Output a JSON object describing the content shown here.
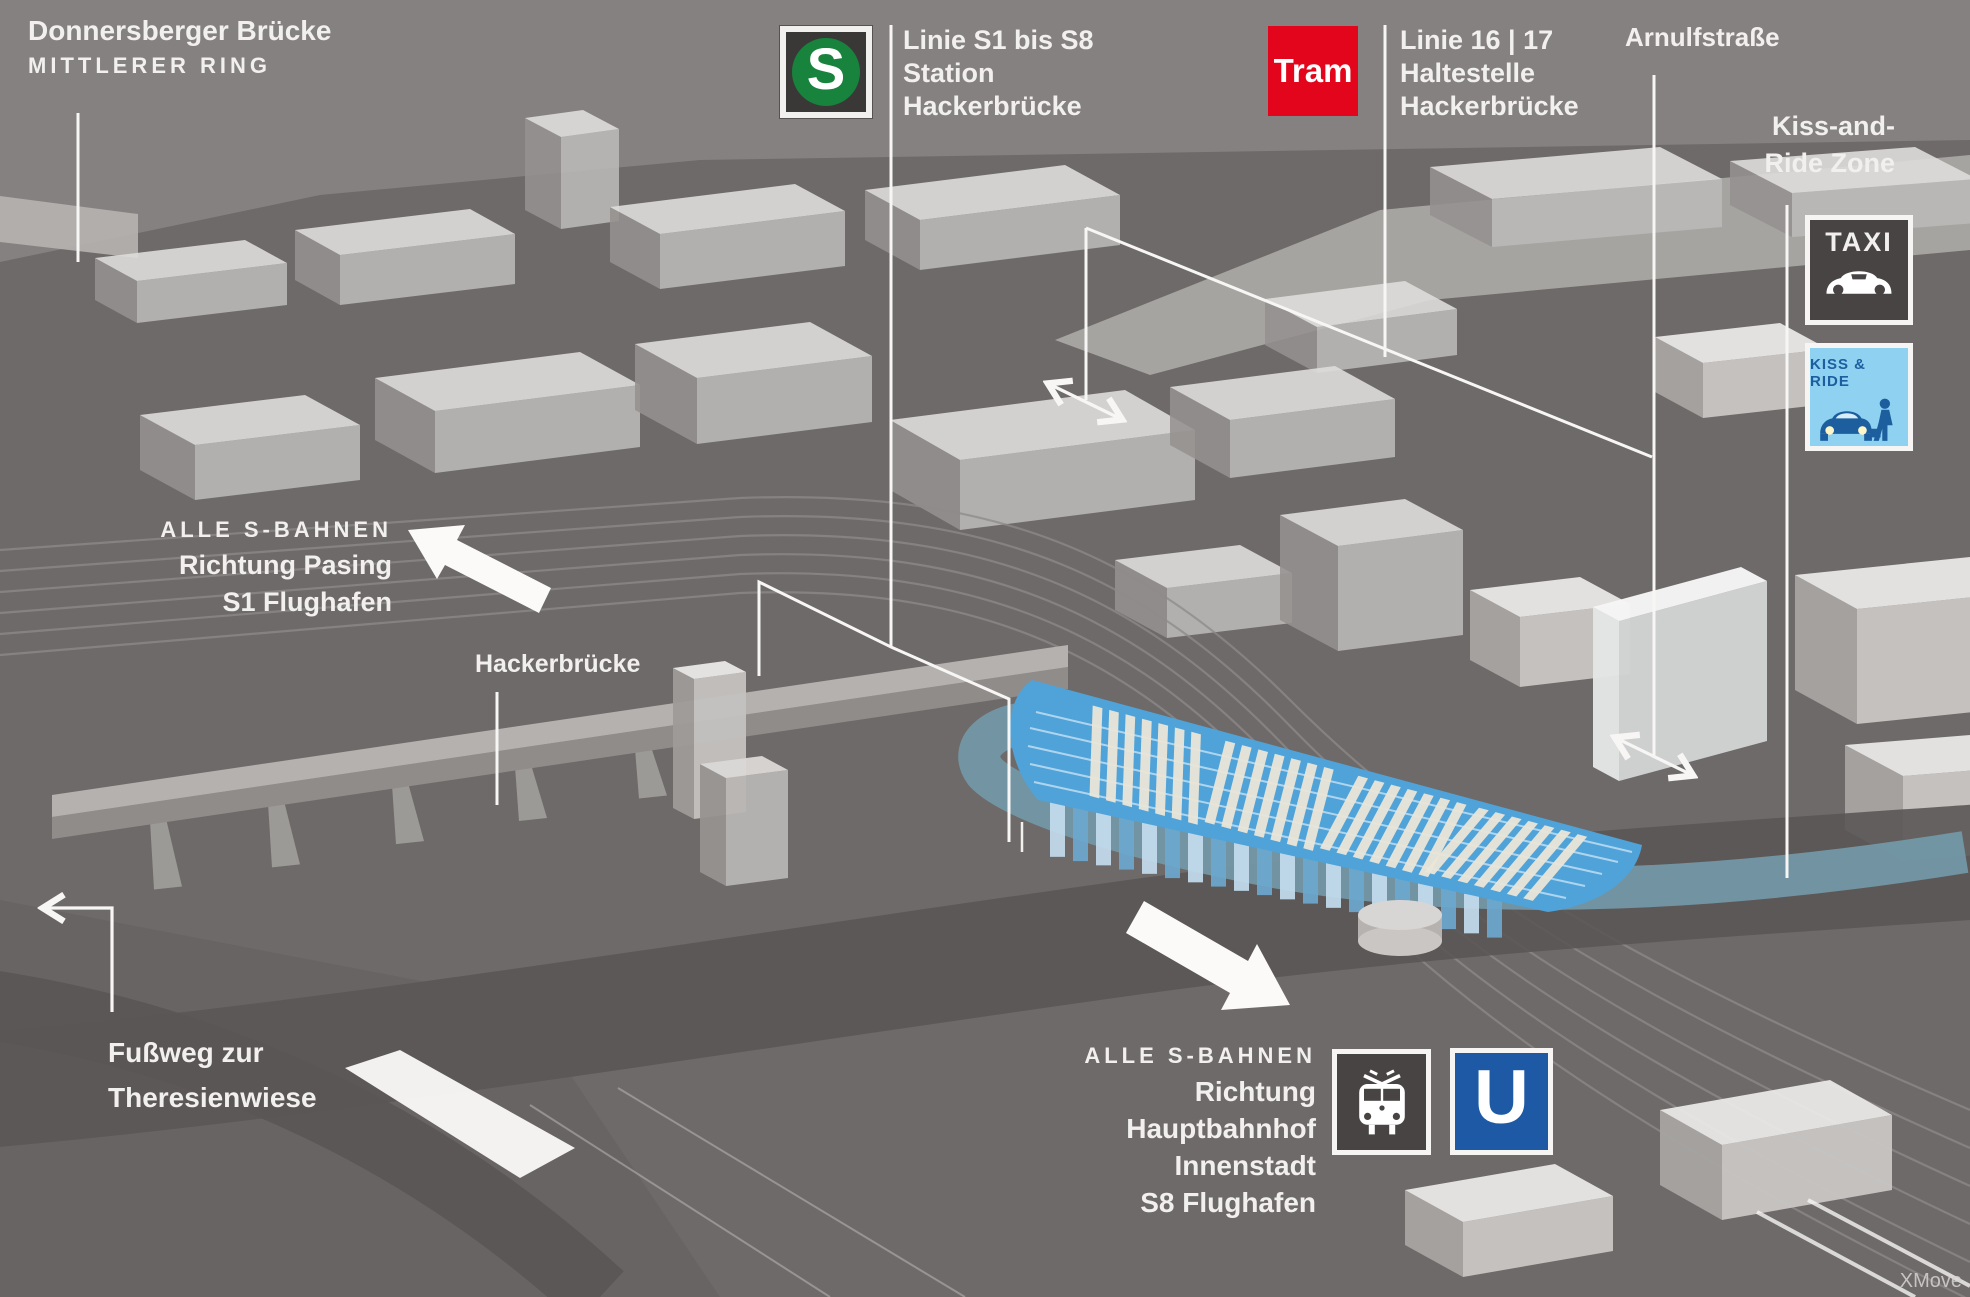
{
  "colors": {
    "background": "#848180",
    "ground": "#6e6a69",
    "road_dark": "#5b5756",
    "teal_road": "#7398a7",
    "roof_blue": "#4fa3d9",
    "text": "#f2f0ee",
    "s_bahn_green": "#17833c",
    "tram_red": "#e3051b",
    "u_bahn_blue": "#1d59a4",
    "sign_dark": "#474443",
    "kiss_ride_bg": "#8ed1f1",
    "kiss_ride_fg": "#1d5f9e"
  },
  "labels": {
    "donnersberger": {
      "title": "Donnersberger Brücke",
      "subtitle": "MITTLERER RING"
    },
    "sbahn_station": {
      "badge": "S",
      "lines": [
        "Linie S1 bis S8",
        "Station",
        "Hackerbrücke"
      ]
    },
    "tram_stop": {
      "badge": "Tram",
      "lines": [
        "Linie 16 | 17",
        "Haltestelle",
        "Hackerbrücke"
      ]
    },
    "arnulfstrasse": {
      "title": "Arnulfstraße"
    },
    "kiss_and_ride": {
      "lines": [
        "Kiss-and-",
        "Ride Zone"
      ],
      "taxi_sign": "TAXI",
      "kiss_sign": "KISS & RIDE"
    },
    "sbahn_west": {
      "heading": "ALLE S-BAHNEN",
      "lines": [
        "Richtung Pasing",
        "S1 Flughafen"
      ]
    },
    "bridge": {
      "title": "Hackerbrücke"
    },
    "footpath": {
      "lines": [
        "Fußweg zur",
        "Theresienwiese"
      ]
    },
    "sbahn_east": {
      "heading": "ALLE S-BAHNEN",
      "lines": [
        "Richtung",
        "Hauptbahnhof",
        "Innenstadt",
        "S8 Flughafen"
      ],
      "badge_u": "U"
    },
    "watermark": "XMove"
  }
}
